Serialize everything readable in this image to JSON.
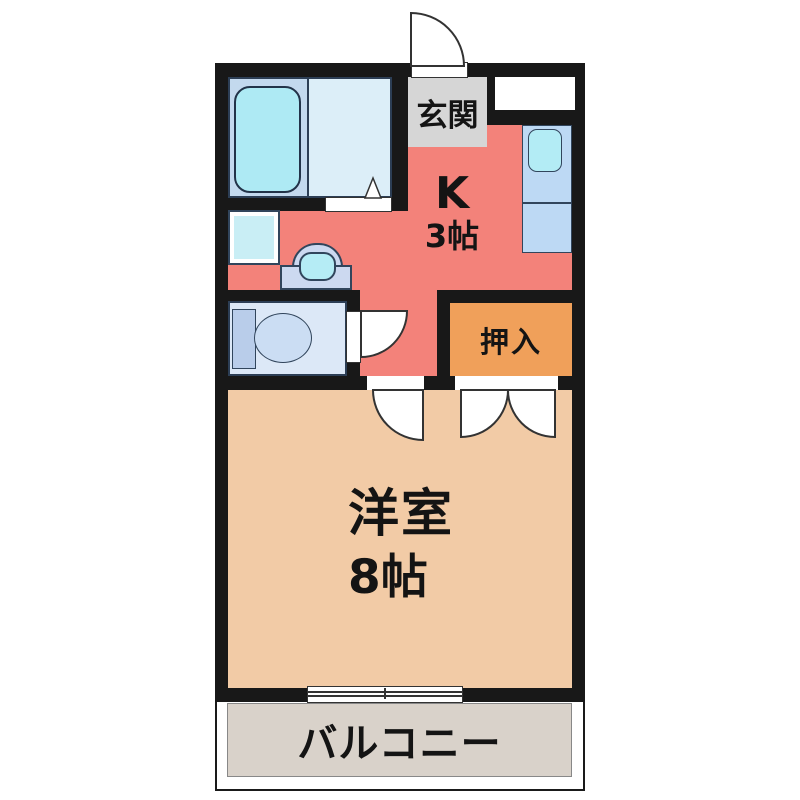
{
  "floorplan": {
    "type": "1K apartment floor plan",
    "rooms": {
      "entrance": {
        "label": "玄関"
      },
      "kitchen": {
        "label": "K",
        "size": "3帖"
      },
      "closet": {
        "label": "押入"
      },
      "western_room": {
        "label": "洋室",
        "size": "8帖"
      },
      "balcony": {
        "label": "バルコニー"
      }
    },
    "colors": {
      "wall": "#181818",
      "kitchen_fill": "#f3827a",
      "western_room_fill": "#f2cba6",
      "closet_fill": "#f0a05a",
      "entrance_fill": "#d6d6d6",
      "balcony_fill": "#d9d2ca",
      "bath_fill": "#c3d9ee",
      "water_fixture_fill": "#aeeaf4"
    }
  }
}
